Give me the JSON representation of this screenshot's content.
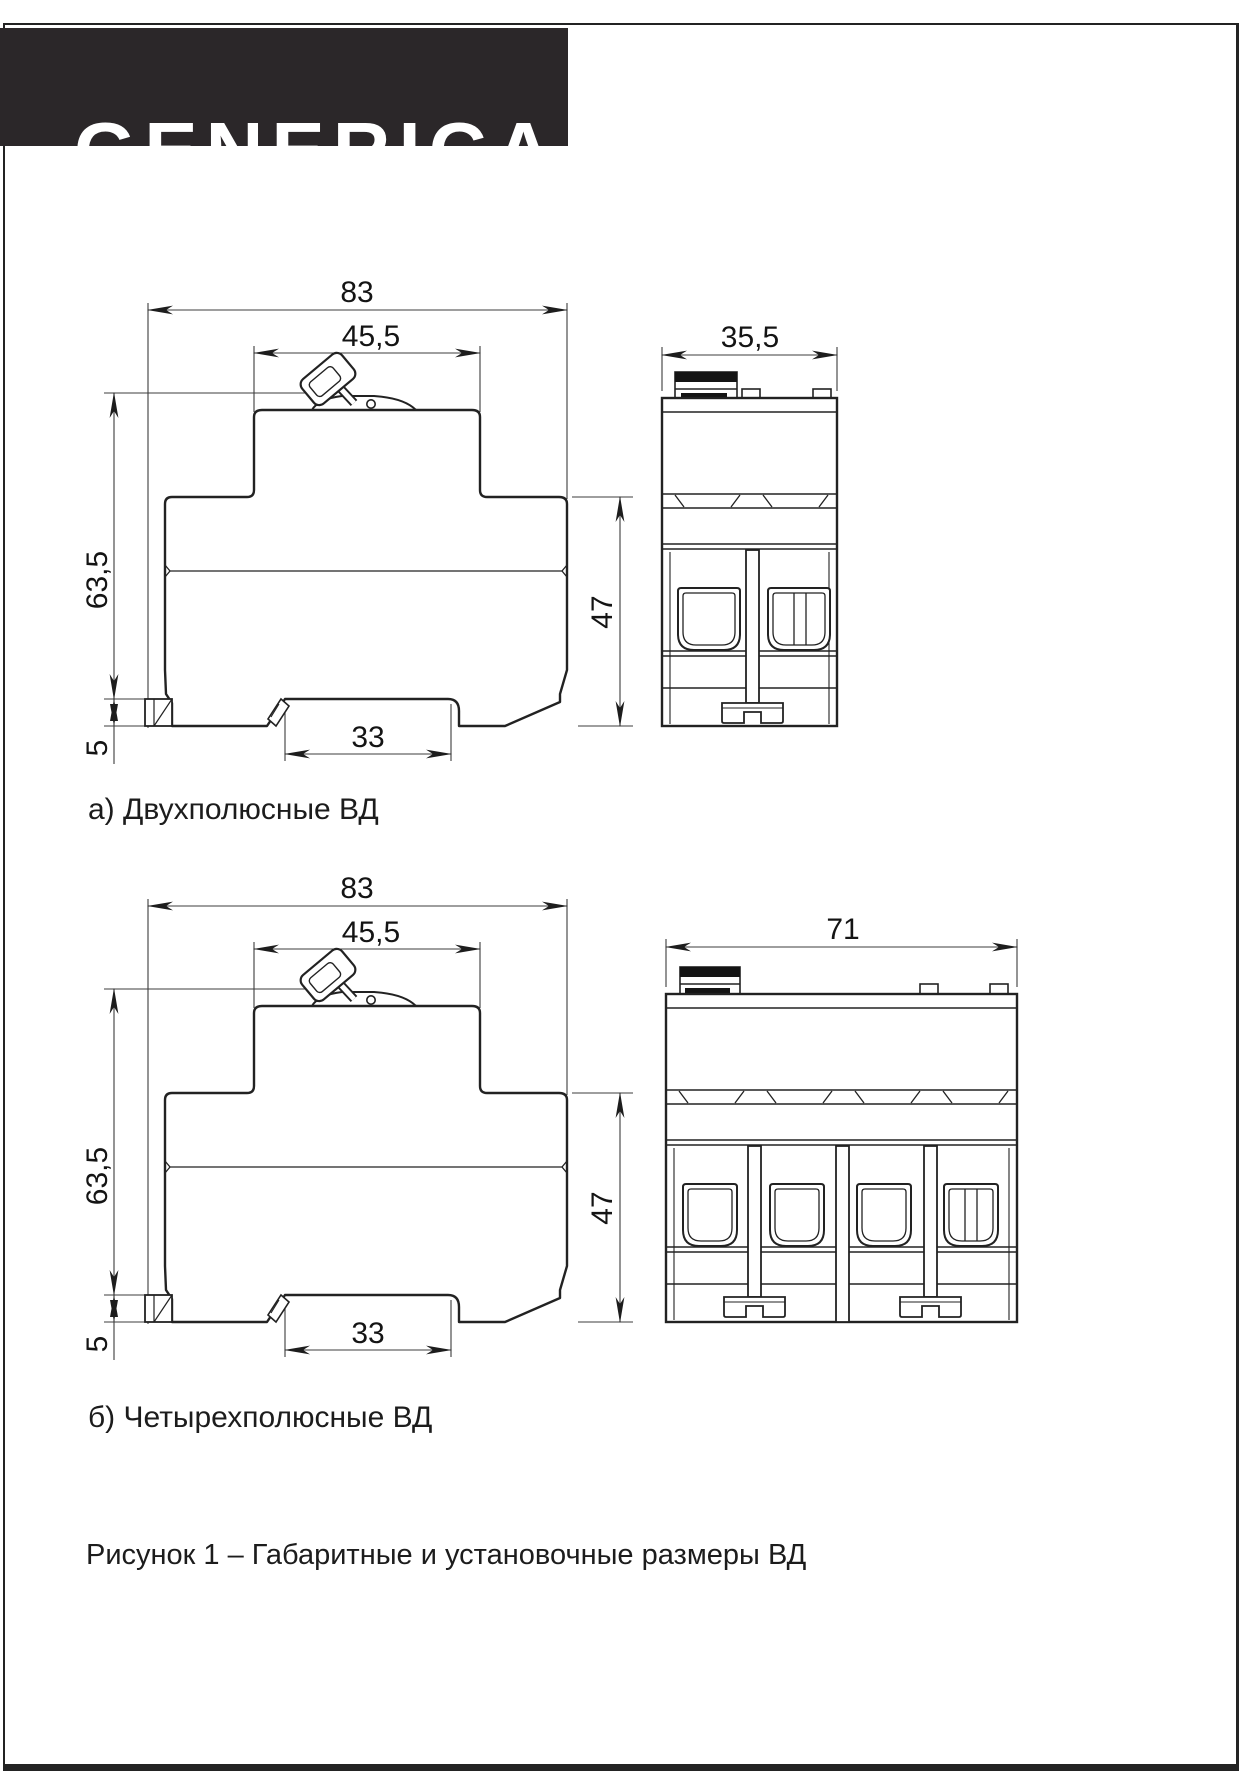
{
  "header": {
    "brand": "GENERICA"
  },
  "figure": {
    "caption": "Рисунок 1 – Габаритные и установочные размеры ВД",
    "sections": [
      {
        "label": "а) Двухполюсные ВД",
        "side": {
          "total_width": "83",
          "top_width": "45,5",
          "height": "63,5",
          "body_height": "47",
          "rail_recess": "33",
          "rail_height": "5"
        },
        "front": {
          "width": "35,5"
        }
      },
      {
        "label": "б) Четырехполюсные ВД",
        "side": {
          "total_width": "83",
          "top_width": "45,5",
          "height": "63,5",
          "body_height": "47",
          "rail_recess": "33",
          "rail_height": "5"
        },
        "front": {
          "width": "71"
        }
      }
    ]
  }
}
